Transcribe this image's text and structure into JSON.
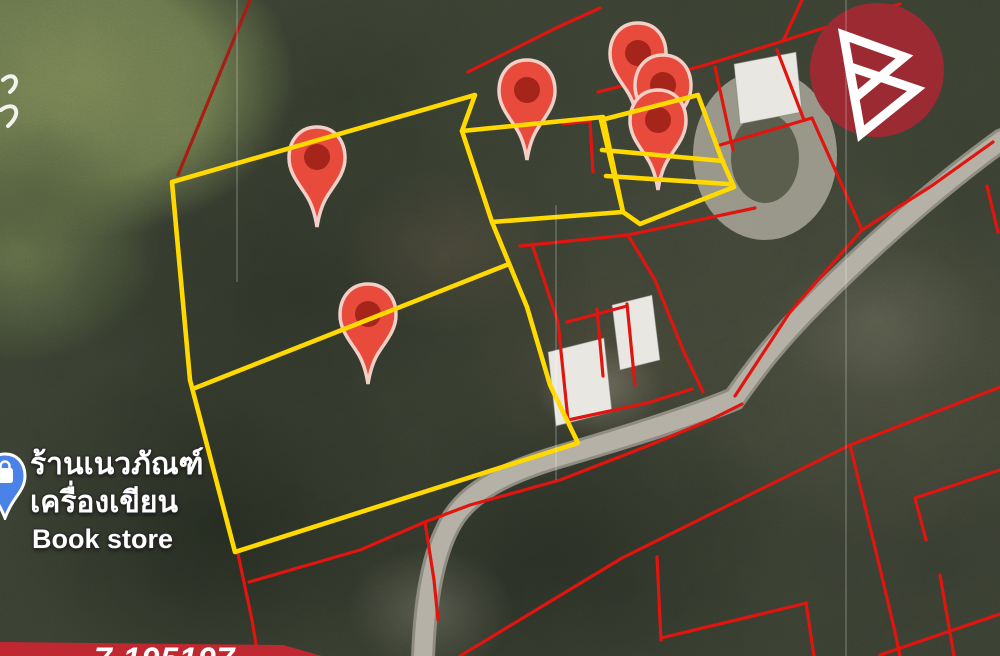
{
  "poi": {
    "name_line1": "ร้านเนวภัณฑ์",
    "name_line2": "เครื่องเขียน",
    "name_line3": "Book store",
    "type": "bookstore-map-label"
  },
  "bottom_ribbon": {
    "text": "7.195197"
  },
  "logo": {
    "shape": "double-triangle-B-monogram"
  },
  "colors": {
    "parcel_highlight": "#ffd900",
    "parcel_boundary": "#e01510",
    "parcel_boundary_dark": "#a81d15",
    "pin_fill": "#e84b3c",
    "pin_core": "#9e2218",
    "pin_outline": "#f2d0c8",
    "logo_bg": "#9c2a33",
    "ribbon_bg": "#bf2830",
    "store_pin_blue": "#4a82e8",
    "road": "#b5b1a6",
    "road_casing": "#8f8c82",
    "building": "#e9e7e2"
  },
  "map_overlay": {
    "road_path": "M 1002,140 C 940,185 880,237 815,302 C 772,345 752,374 734,399 C 698,414 640,433 565,455 C 505,472 468,492 451,522 C 433,553 425,600 423,658",
    "driveway": {
      "cx": 765,
      "cy": 155,
      "rx": 72,
      "ry": 85,
      "icx": 765,
      "icy": 158,
      "irx": 34,
      "iry": 45
    },
    "buildings": [
      "548,352 604,338 612,412 556,426",
      "612,305 652,295 660,360 620,370",
      "734,64 796,52 802,112 740,124"
    ],
    "seams": [
      {
        "x": 237,
        "y1": 0,
        "y2": 282
      },
      {
        "x": 556,
        "y1": 205,
        "y2": 480
      },
      {
        "x": 846,
        "y1": 0,
        "y2": 656
      }
    ],
    "red_lines": [
      {
        "pts": "250,0 178,175",
        "color": "#a81d15"
      },
      {
        "pts": "468,72 556,28 600,8"
      },
      {
        "pts": "598,92 702,66 783,41 858,17 900,4"
      },
      {
        "pts": "802,0 783,41"
      },
      {
        "pts": "563,124 590,121 593,172"
      },
      {
        "pts": "715,67 733,150"
      },
      {
        "pts": "777,50 804,120"
      },
      {
        "pts": "720,145 812,118"
      },
      {
        "pts": "812,118 862,230"
      },
      {
        "pts": "993,142 930,187 862,230 790,312 735,396"
      },
      {
        "pts": "987,186 998,232"
      },
      {
        "pts": "520,246 628,235 755,208"
      },
      {
        "pts": "532,244 558,322 568,420"
      },
      {
        "pts": "567,322 627,306"
      },
      {
        "pts": "597,309 603,376"
      },
      {
        "pts": "627,304 635,385"
      },
      {
        "pts": "568,420 647,403 692,389"
      },
      {
        "pts": "628,235 655,280 683,350 703,392"
      },
      {
        "pts": "238,554 252,620 258,656"
      },
      {
        "pts": "249,582 360,550 425,522"
      },
      {
        "pts": "425,522 470,505 560,480 645,447 710,420 742,404"
      },
      {
        "pts": "425,522 434,580 438,620"
      },
      {
        "pts": "460,656 622,558 850,445 1000,387"
      },
      {
        "pts": "657,557 661,640"
      },
      {
        "pts": "661,638 807,603"
      },
      {
        "pts": "806,603 814,656"
      },
      {
        "pts": "850,445 878,560 895,632 900,656"
      },
      {
        "pts": "1000,470 915,498 926,540"
      },
      {
        "pts": "940,575 954,656"
      },
      {
        "pts": "880,655 1000,614"
      }
    ],
    "pins": [
      {
        "cx": 317,
        "cy": 157
      },
      {
        "cx": 527,
        "cy": 90
      },
      {
        "cx": 638,
        "cy": 53
      },
      {
        "cx": 663,
        "cy": 85
      },
      {
        "cx": 658,
        "cy": 120
      },
      {
        "cx": 368,
        "cy": 314
      }
    ],
    "yellow_lines": [
      {
        "pts": "172,182 475,95 462,131 492,222 527,307 550,385 578,443 235,552 190,380 172,182"
      },
      {
        "pts": "195,388 509,264"
      },
      {
        "pts": "462,131 603,117 623,212 492,222"
      },
      {
        "pts": "601,120 698,95 722,160 734,187 640,224 623,212 601,120"
      },
      {
        "pts": "602,150 723,161"
      },
      {
        "pts": "606,176 729,184"
      }
    ],
    "logo_circle": {
      "cx": 877,
      "cy": 70,
      "r": 67
    },
    "logo_triangles": [
      "852,30 908,62 852,94",
      "852,62 914,96 852,130"
    ],
    "label_fragments": [
      "M 3,80 C 14,70 22,82 10,92",
      "M 1,110 C 14,100 24,112 8,126"
    ]
  }
}
